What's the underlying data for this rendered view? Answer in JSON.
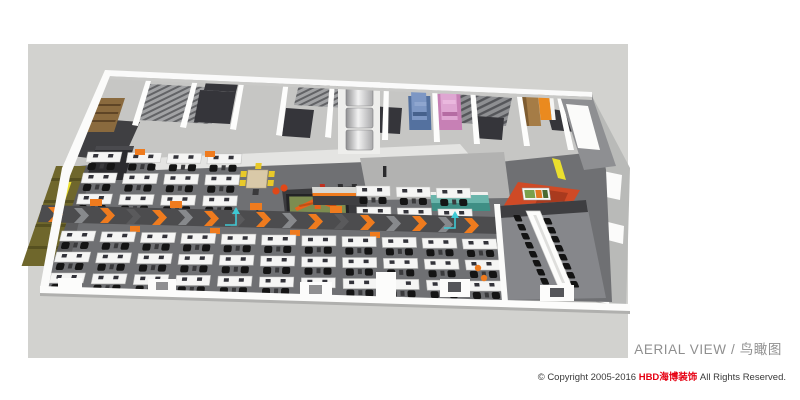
{
  "artboard": {
    "width": 800,
    "height": 400,
    "background": "#ffffff"
  },
  "rendering": {
    "label": "aerial 3d rendering of an open office floor",
    "canvas_color": "#d2d2cf",
    "floor_number_marker": "3"
  },
  "caption": {
    "en": "AERIAL VIEW",
    "separator": " / ",
    "zh": "鸟瞰图"
  },
  "copyright": {
    "prefix": "© Copyright 2005-2016 ",
    "brand": "HBD海博装饰",
    "suffix": " All Rights Reserved."
  },
  "palette": {
    "backdrop": "#d2d2cf",
    "office_floor": "#717174",
    "walkway_base": "#4c4c4e",
    "accent_orange": "#ef7b1e",
    "desk_white": "#f5f5f4",
    "chair_black": "#141414",
    "wall_white": "#fbfbfa",
    "dark_room": "#35353a",
    "wood": "#a57c46",
    "shelf_blue": "#54719f",
    "shelf_pink": "#c780b5",
    "locker_orange": "#ea8a1f",
    "cabinet_olive": "#6f672c",
    "accent_yellow": "#eadf2e",
    "feature_red": "#cf4a26",
    "cabinet_teal": "#5fb0a6",
    "logo_green": "#7d8c50",
    "logo_orange": "#e8621c",
    "marker_cyan": "#3ec8d4",
    "caption_gray": "#8f8f8f",
    "copyright_dark": "#3a3a3a",
    "brand_red": "#e60012"
  }
}
